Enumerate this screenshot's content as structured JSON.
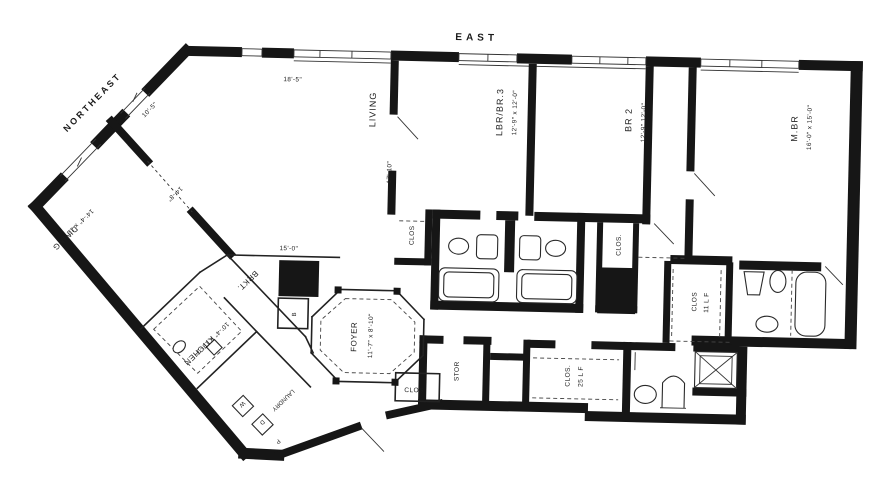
{
  "compass": {
    "east": "EAST",
    "northeast": "NORTHEAST"
  },
  "rooms": {
    "living": {
      "name": "LIVING",
      "dim": "17'-10\""
    },
    "lbr_br3": {
      "name": "LBR/BR.3",
      "dim": "12'-9\" x 12'-0\""
    },
    "br2": {
      "name": "BR 2",
      "dim": "12'-9\" 12'-0\""
    },
    "mbr": {
      "name": "M.BR",
      "dim": "16'-0\" x 15'-0\""
    },
    "dining": {
      "name": "DINING",
      "dim": "14'-4\" x 12'-0\""
    },
    "kitchen": {
      "name": "KITCHEN",
      "dim": "10'-4\" x 13'-9\""
    },
    "foyer": {
      "name": "FOYER",
      "dim": "11'-7\" x 8'-10\""
    },
    "brkt": {
      "name": "BRKT."
    },
    "bar": {
      "name": "B"
    },
    "stor": {
      "name": "STOR"
    },
    "laundry": {
      "name": "LAUNDRY",
      "washer": "W",
      "dryer": "D",
      "pantry": "P"
    }
  },
  "closets": {
    "clos_living": "CLOS",
    "clos_foyer": "CLOS",
    "clos_shaft": "CLOS.",
    "clos_master": {
      "name": "CLOS",
      "size": "11 L F"
    },
    "clos_25": {
      "name": "CLOS.",
      "size": "25 L F"
    }
  },
  "dimensions": {
    "top_window": "18'-5\"",
    "northeast_wall": "10'-5\"",
    "living_dining_wall": "14'-8\"",
    "brkt_span": "15'-0\""
  }
}
